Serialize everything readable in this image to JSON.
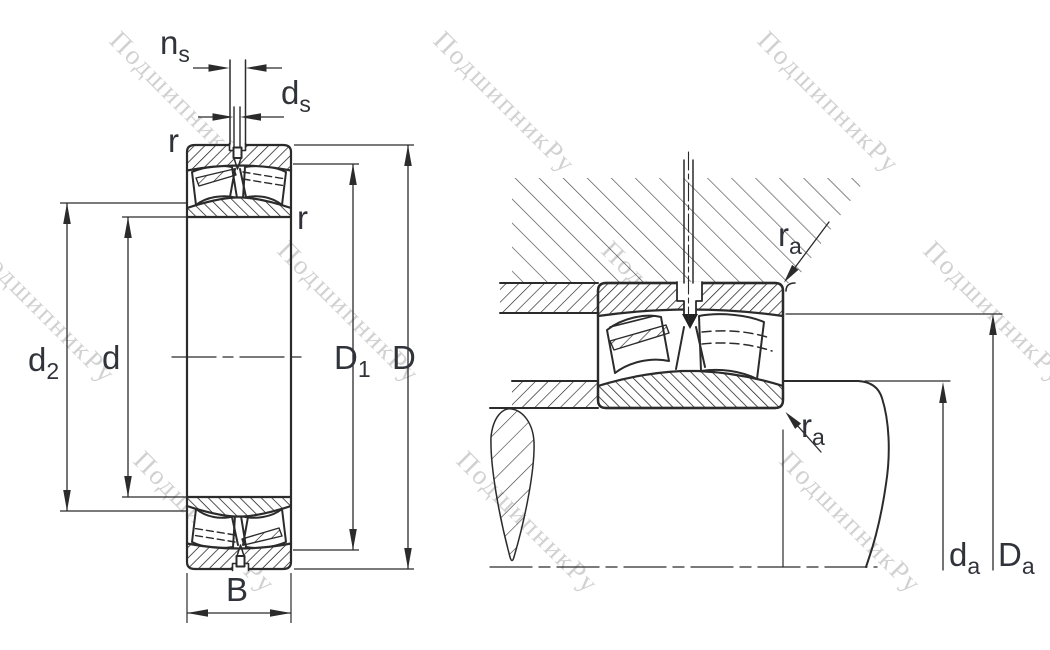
{
  "watermark": {
    "text": "ПодшипникРу"
  },
  "dimension_labels": {
    "ns": {
      "base": "n",
      "sub": "s"
    },
    "ds": {
      "base": "d",
      "sub": "s"
    },
    "r_outer": {
      "base": "r"
    },
    "r_inner": {
      "base": "r"
    },
    "d2": {
      "base": "d",
      "sub": "2"
    },
    "d": {
      "base": "d"
    },
    "D1": {
      "base": "D",
      "sub": "1"
    },
    "D": {
      "base": "D"
    },
    "B": {
      "base": "B"
    },
    "ra_housing": {
      "base": "r",
      "sub": "a"
    },
    "ra_shaft": {
      "base": "r",
      "sub": "a"
    },
    "da": {
      "base": "d",
      "sub": "a"
    },
    "Da": {
      "base": "D",
      "sub": "a"
    }
  },
  "colors": {
    "line": "#2b2b2b",
    "label": "#30333a",
    "watermark": "#b5b5b5",
    "background": "#ffffff"
  }
}
